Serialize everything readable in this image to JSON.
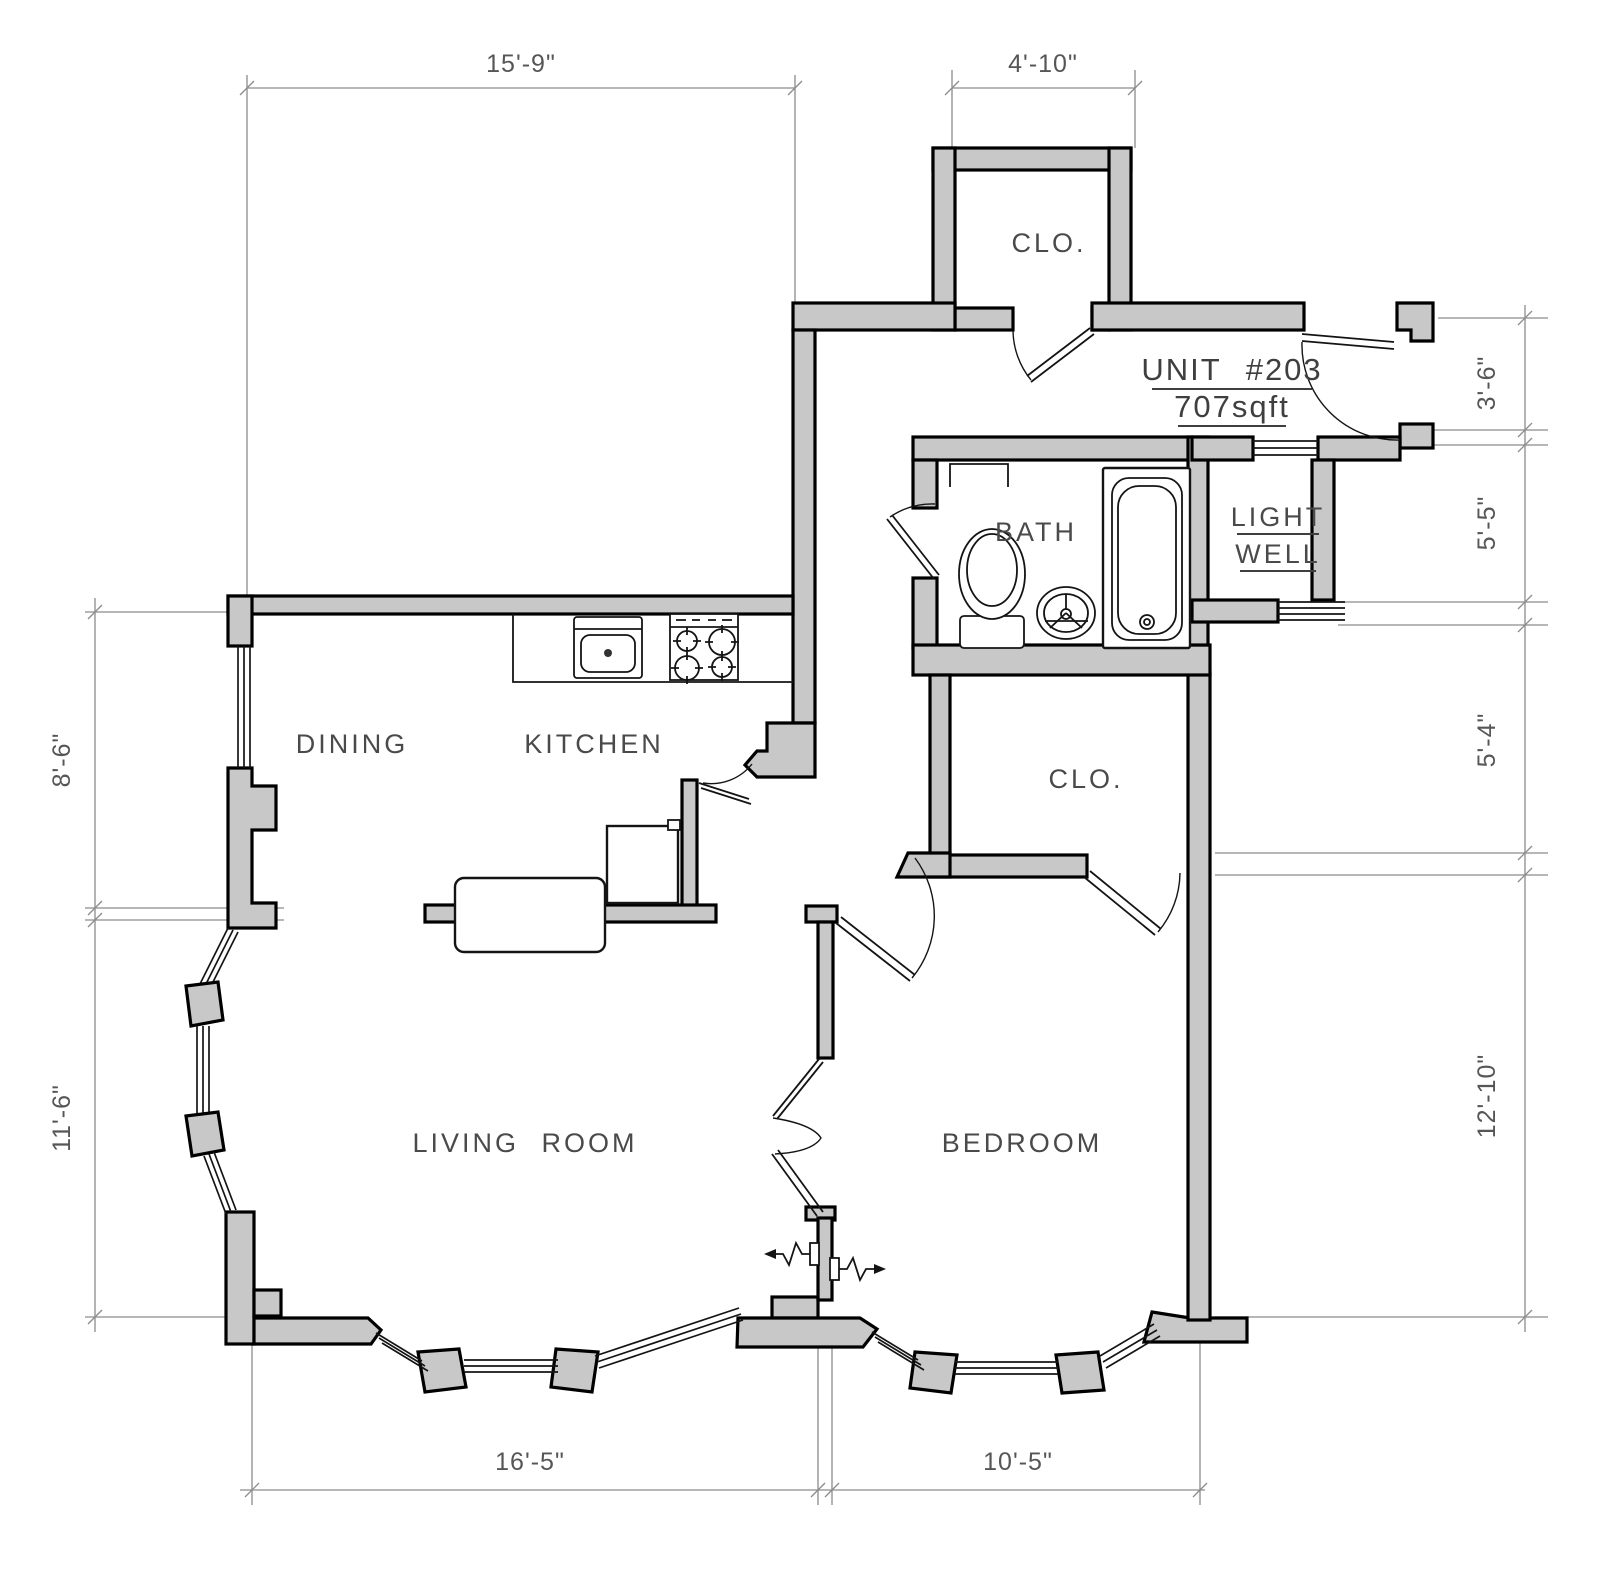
{
  "plan": {
    "unit": {
      "label": "UNIT #203",
      "area": "707sqft"
    },
    "rooms": {
      "dining": "DINING",
      "kitchen": "KITCHEN",
      "living_room": "LIVING ROOM",
      "bedroom": "BEDROOM",
      "bath": "BATH",
      "light_well_line1": "LIGHT",
      "light_well_line2": "WELL",
      "entry_closet": "CLO.",
      "bedroom_closet": "CLO."
    },
    "dimensions": {
      "top_width": "15'-9\"",
      "entry_closet_width": "4'-10\"",
      "right_entry": "3'-6\"",
      "right_bath": "5'-5\"",
      "right_closet": "5'-4\"",
      "right_bedroom": "12'-10\"",
      "left_dining": "8'-6\"",
      "left_living": "11'-6\"",
      "bottom_living": "16'-5\"",
      "bottom_bedroom": "10'-5\""
    },
    "colors": {
      "wall_fill": "#c8c8c8",
      "wall_outline": "#000000",
      "dimension_line": "#8c8c8c",
      "label_text": "#4a4a4a"
    }
  }
}
